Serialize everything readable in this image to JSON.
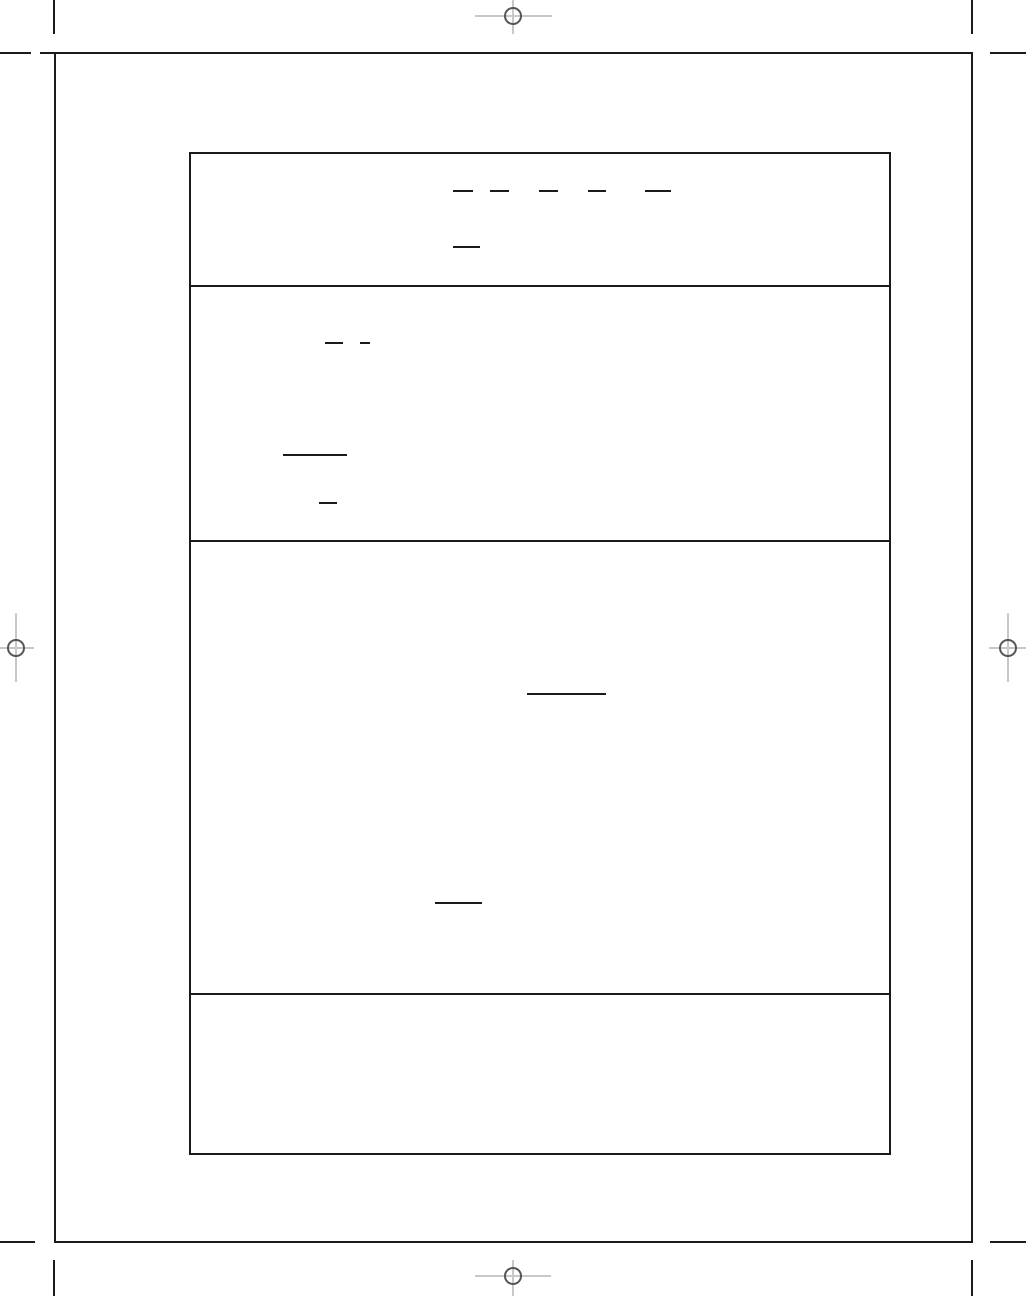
{
  "page": {
    "width": 1026,
    "height": 1296,
    "background_color": "#ffffff",
    "ink_color": "#1b1b1b",
    "registration_cross_color": "#c8c8c8",
    "registration_circle_color": "#555555",
    "visible_text": ""
  },
  "print_marks": {
    "crop_marks": [
      {
        "id": "top-left-vertical",
        "x": 53,
        "y": 0,
        "w": 2,
        "h": 34
      },
      {
        "id": "top-left-horizontal",
        "x": 0,
        "y": 52,
        "w": 31,
        "h": 2
      },
      {
        "id": "top-right-vertical",
        "x": 971,
        "y": 0,
        "w": 2,
        "h": 34
      },
      {
        "id": "top-right-horizontal",
        "x": 990,
        "y": 52,
        "w": 36,
        "h": 2
      },
      {
        "id": "bottom-left-horizontal",
        "x": 0,
        "y": 1241,
        "w": 35,
        "h": 2
      },
      {
        "id": "bottom-left-vertical",
        "x": 53,
        "y": 1260,
        "w": 2,
        "h": 36
      },
      {
        "id": "bottom-right-horizontal",
        "x": 990,
        "y": 1241,
        "w": 36,
        "h": 2
      },
      {
        "id": "bottom-right-vertical",
        "x": 971,
        "y": 1260,
        "w": 2,
        "h": 36
      },
      {
        "id": "sheet-top-left-overhang",
        "x": 40,
        "y": 52,
        "w": 16,
        "h": 2
      }
    ],
    "registration_marks": [
      {
        "id": "top-center",
        "cx": 513,
        "cy": 16,
        "r": 9,
        "h_from": 475,
        "h_to": 552,
        "v_from": 0,
        "v_to": 34
      },
      {
        "id": "left-middle",
        "cx": 16,
        "cy": 648,
        "r": 9,
        "h_from": 0,
        "h_to": 34,
        "v_from": 613,
        "v_to": 682
      },
      {
        "id": "right-middle",
        "cx": 1008,
        "cy": 648,
        "r": 9,
        "h_from": 989,
        "h_to": 1026,
        "v_from": 613,
        "v_to": 682
      },
      {
        "id": "bottom-center",
        "cx": 513,
        "cy": 1276,
        "r": 9,
        "h_from": 475,
        "h_to": 551,
        "v_from": 1260,
        "v_to": 1296
      }
    ]
  },
  "sheet": {
    "x": 54,
    "y": 52,
    "w": 919,
    "h": 1191
  },
  "form": {
    "box": {
      "x": 189,
      "y": 152,
      "w": 702,
      "h": 1003
    },
    "dividers_y": [
      283,
      538,
      991
    ],
    "sections": [
      {
        "id": "section-1",
        "rules": [
          {
            "x": 453,
            "y": 190,
            "w": 20
          },
          {
            "x": 490,
            "y": 190,
            "w": 19
          },
          {
            "x": 539,
            "y": 190,
            "w": 19
          },
          {
            "x": 588,
            "y": 190,
            "w": 18
          },
          {
            "x": 645,
            "y": 190,
            "w": 26
          },
          {
            "x": 453,
            "y": 246,
            "w": 27
          }
        ]
      },
      {
        "id": "section-2",
        "rules": [
          {
            "x": 325,
            "y": 342,
            "w": 18
          },
          {
            "x": 360,
            "y": 342,
            "w": 10
          },
          {
            "x": 283,
            "y": 454,
            "w": 64
          },
          {
            "x": 319,
            "y": 502,
            "w": 18
          }
        ]
      },
      {
        "id": "section-3",
        "rules": [
          {
            "x": 527,
            "y": 693,
            "w": 79
          },
          {
            "x": 435,
            "y": 902,
            "w": 47
          }
        ]
      },
      {
        "id": "section-4",
        "rules": []
      }
    ]
  }
}
